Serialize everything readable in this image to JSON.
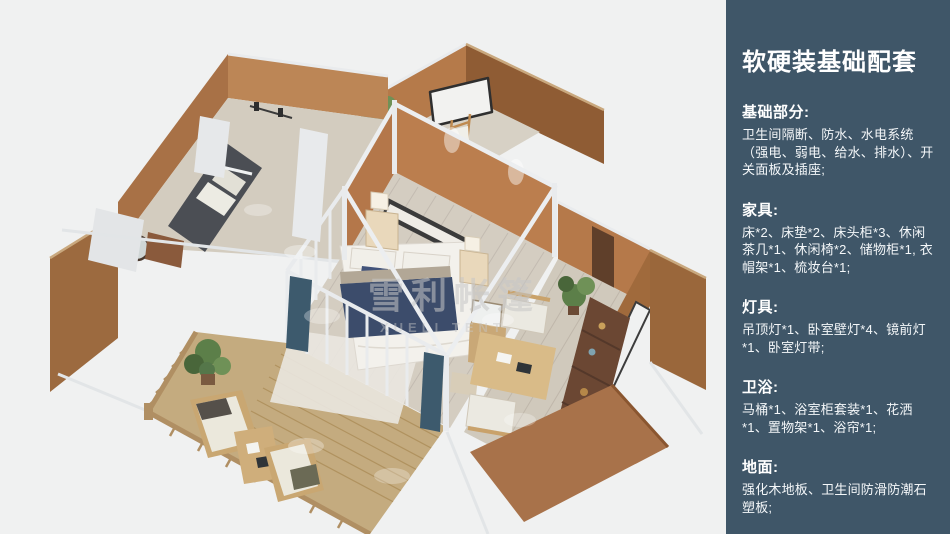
{
  "panel": {
    "title": "软硬装基础配套",
    "bg_color": "#3f5668",
    "text_color": "#ffffff",
    "sections": [
      {
        "heading": "基础部分:",
        "body": "卫生间隔断、防水、水电系统（强电、弱电、给水、排水）、开关面板及插座;"
      },
      {
        "heading": "家具:",
        "body": "床*2、床垫*2、床头柜*3、休闲茶几*1、休闲椅*2、储物柜*1, 衣帽架*1、梳妆台*1;"
      },
      {
        "heading": "灯具:",
        "body": "吊顶灯*1、卧室壁灯*4、镜前灯*1、卧室灯带;"
      },
      {
        "heading": "卫浴:",
        "body": "马桶*1、浴室柜套装*1、花洒*1、置物架*1、浴帘*1;"
      },
      {
        "heading": "地面:",
        "body": "强化木地板、卫生间防滑防潮石塑板;"
      }
    ]
  },
  "illustration": {
    "description": "3D bird's-eye rendering of a glamping tent suite: central bedroom with double bed, dressing room, bathroom, lounge room with desk and shelf, and a wooden deck with loungers",
    "watermark": "雪利帐篷",
    "watermark_latin": "XUELI TENT",
    "colors": {
      "background": "#f0f1f1",
      "wall_tan": "#b5794a",
      "wall_dark": "#8f5c34",
      "floor_wood": "#d4cdc1",
      "deck_wood": "#c4ab7f",
      "frame_white": "#eceef0",
      "bed_navy": "#3c4c6b",
      "curtain_teal": "#3d5a6d",
      "plant_green": "#5c7f49"
    }
  }
}
